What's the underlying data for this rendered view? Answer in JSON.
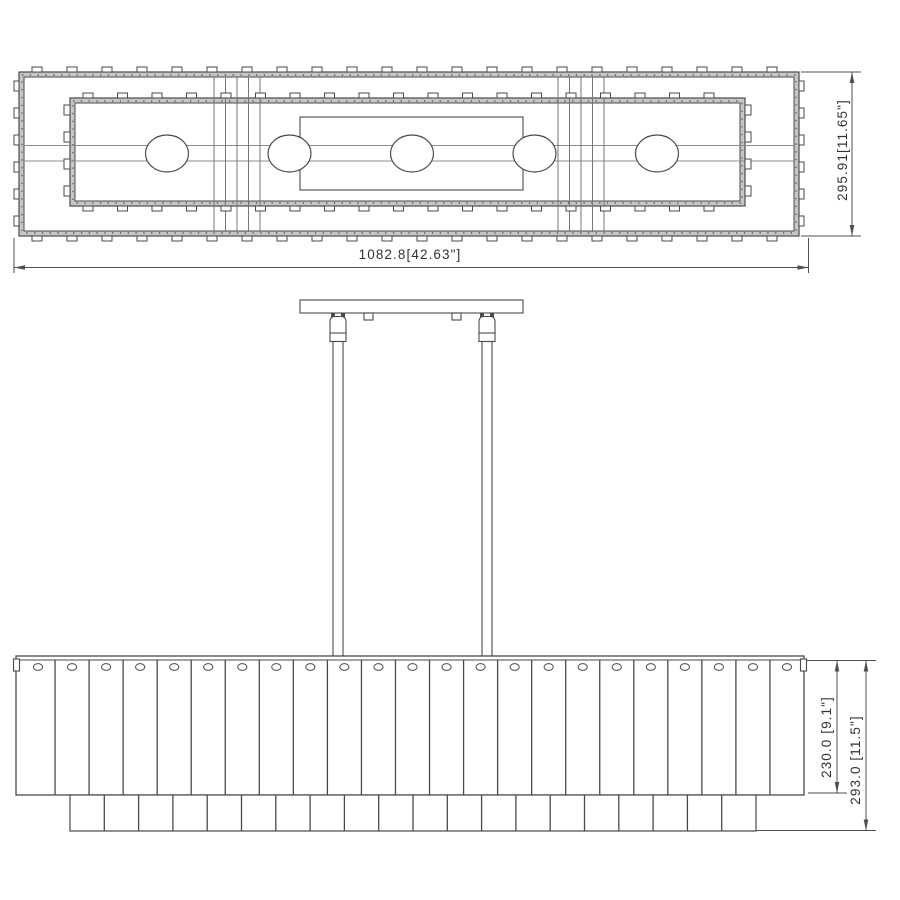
{
  "drawing": {
    "type": "technical-dimension-drawing",
    "subject": "5-light linear chandelier with crystal panel shade",
    "top_view": {
      "overall_width_dim": "1082.8[42.63\"]",
      "overall_depth_dim": "295.91[11.65\"]",
      "bulb_count": 5,
      "crossbar_group_count": 2
    },
    "side_view": {
      "shade_height_dim": "230.0 [9.1\"]",
      "overall_height_dim": "293.0 [11.5\"]",
      "upper_panel_count": 23,
      "lower_panel_count": 20,
      "rod_count": 2
    },
    "colors": {
      "line": "#4a4a4a",
      "band_fill": "#c6c6c6",
      "band_dots": "#222222",
      "soft_line": "#8d8d8d",
      "crossbar_line": "#757575",
      "dim_line": "#4f4f4f",
      "text": "#333333",
      "background": "#ffffff"
    }
  }
}
